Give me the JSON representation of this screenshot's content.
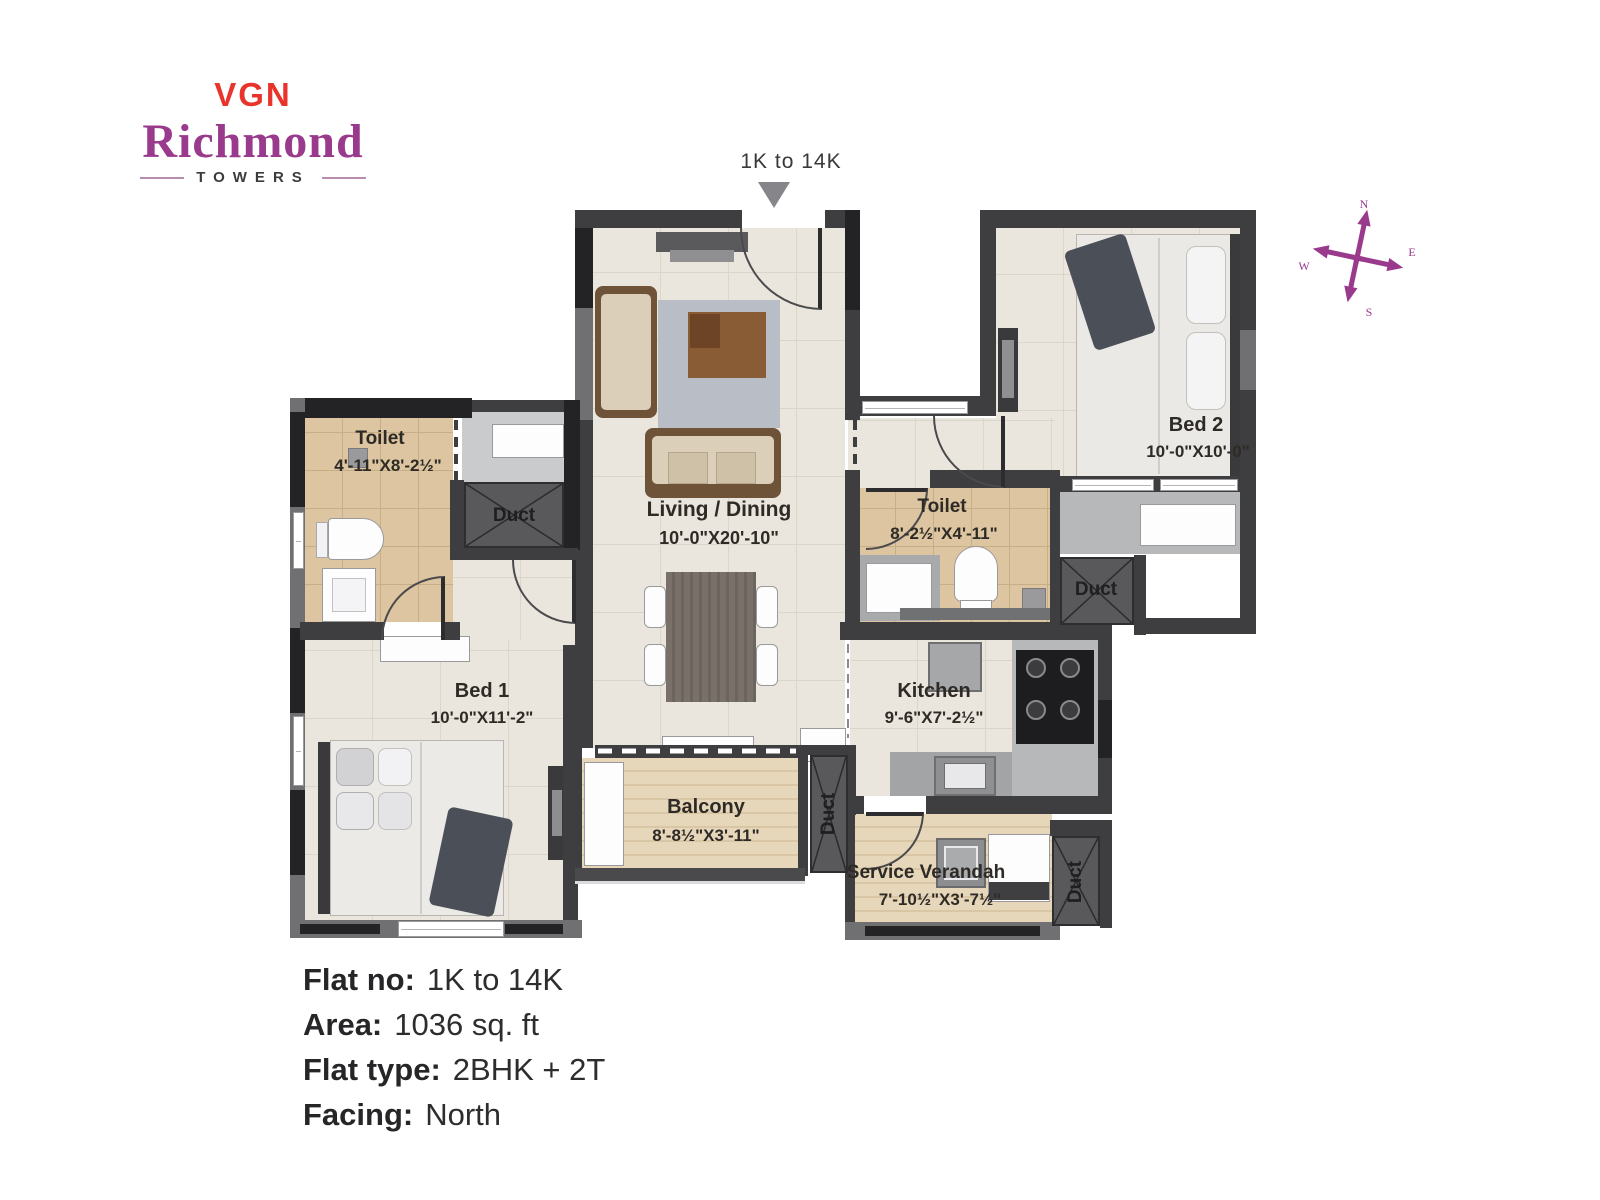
{
  "brand": {
    "vgn": "VGN",
    "name": "Richmond",
    "sub": "TOWERS"
  },
  "entrance_label": "1K to 14K",
  "compass": {
    "n": "N",
    "e": "E",
    "s": "S",
    "w": "W"
  },
  "plan": {
    "living": {
      "name": "Living / Dining",
      "dims": "10'-0\"X20'-10\""
    },
    "bed1": {
      "name": "Bed 1",
      "dims": "10'-0\"X11'-2\""
    },
    "bed2": {
      "name": "Bed 2",
      "dims": "10'-0\"X10'-0\""
    },
    "toilet1": {
      "name": "Toilet",
      "dims": "4'-11\"X8'-2½\""
    },
    "toilet2": {
      "name": "Toilet",
      "dims": "8'-2½\"X4'-11\""
    },
    "kitchen": {
      "name": "Kitchen",
      "dims": "9'-6\"X7'-2½\""
    },
    "balcony": {
      "name": "Balcony",
      "dims": "8'-8½\"X3'-11\""
    },
    "service_verandah": {
      "name": "Service Verandah",
      "dims": "7'-10½\"X3'-7½\""
    },
    "duct1": "Duct",
    "duct2": "Duct",
    "duct3": "Duct",
    "duct4": "Duct"
  },
  "details": [
    {
      "label": "Flat no:",
      "value": "1K to 14K"
    },
    {
      "label": "Area:",
      "value": "1036 sq. ft"
    },
    {
      "label": "Flat type:",
      "value": "2BHK + 2T"
    },
    {
      "label": "Facing:",
      "value": "North"
    }
  ],
  "colors": {
    "accent_red": "#e8342b",
    "accent_purple": "#9a3a8c",
    "wall_dark": "#3e3e40",
    "floor_cream": "#eae6dd",
    "floor_tan": "#dcc5a0"
  }
}
